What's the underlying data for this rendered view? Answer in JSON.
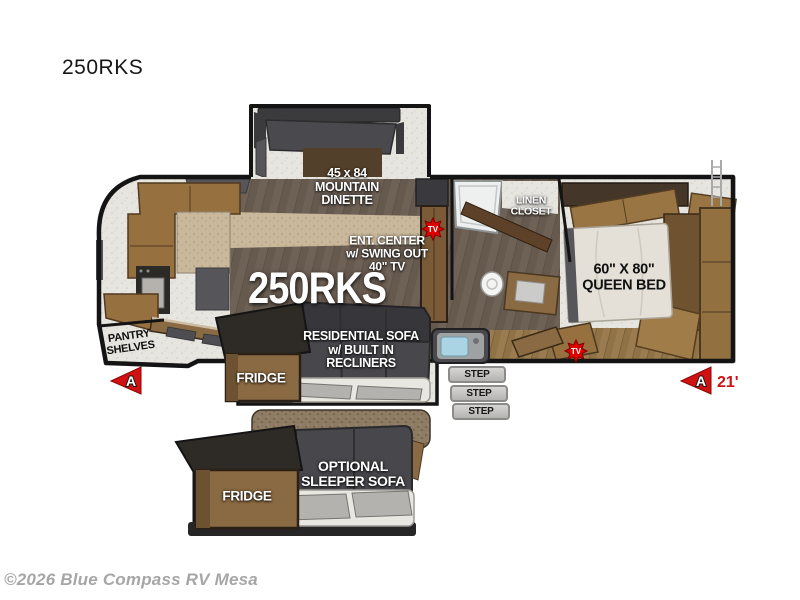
{
  "page": {
    "title": "250RKS",
    "copyright": "©2026 Blue Compass RV Mesa"
  },
  "colors": {
    "accent_red": "#d01111",
    "wood_cabinet": "#96713f",
    "wood_dark_panel": "#53402a",
    "floor_plank": "#6e6156",
    "sofa_gray": "#47474c",
    "carpet": "#e7e5e0",
    "outline_black": "#141414",
    "step_gray": "#c6c5c3",
    "sink_blue": "#aad4e4"
  },
  "floorplan": {
    "model": "250RKS",
    "length_marker": "21'",
    "marker_letter": "A",
    "tv_icon": "TV",
    "labels": {
      "dinette": {
        "l1": "45 x 84",
        "l2": "MOUNTAIN",
        "l3": "DINETTE"
      },
      "ent_center": {
        "l1": "ENT. CENTER",
        "l2": "w/ SWING OUT",
        "l3": "40\" TV"
      },
      "linen": {
        "l1": "LINEN",
        "l2": "CLOSET"
      },
      "queen_bed": {
        "l1": "60\" X 80\"",
        "l2": "QUEEN BED"
      },
      "pantry": {
        "l1": "PANTRY",
        "l2": "SHELVES"
      },
      "fridge": "FRIDGE",
      "residential_sofa": {
        "l1": "RESIDENTIAL SOFA",
        "l2": "w/ BUILT IN",
        "l3": "RECLINERS"
      },
      "optional_sofa": {
        "l1": "OPTIONAL",
        "l2": "SLEEPER SOFA"
      },
      "fridge_optional": "FRIDGE",
      "steps": [
        "STEP",
        "STEP",
        "STEP"
      ]
    }
  }
}
